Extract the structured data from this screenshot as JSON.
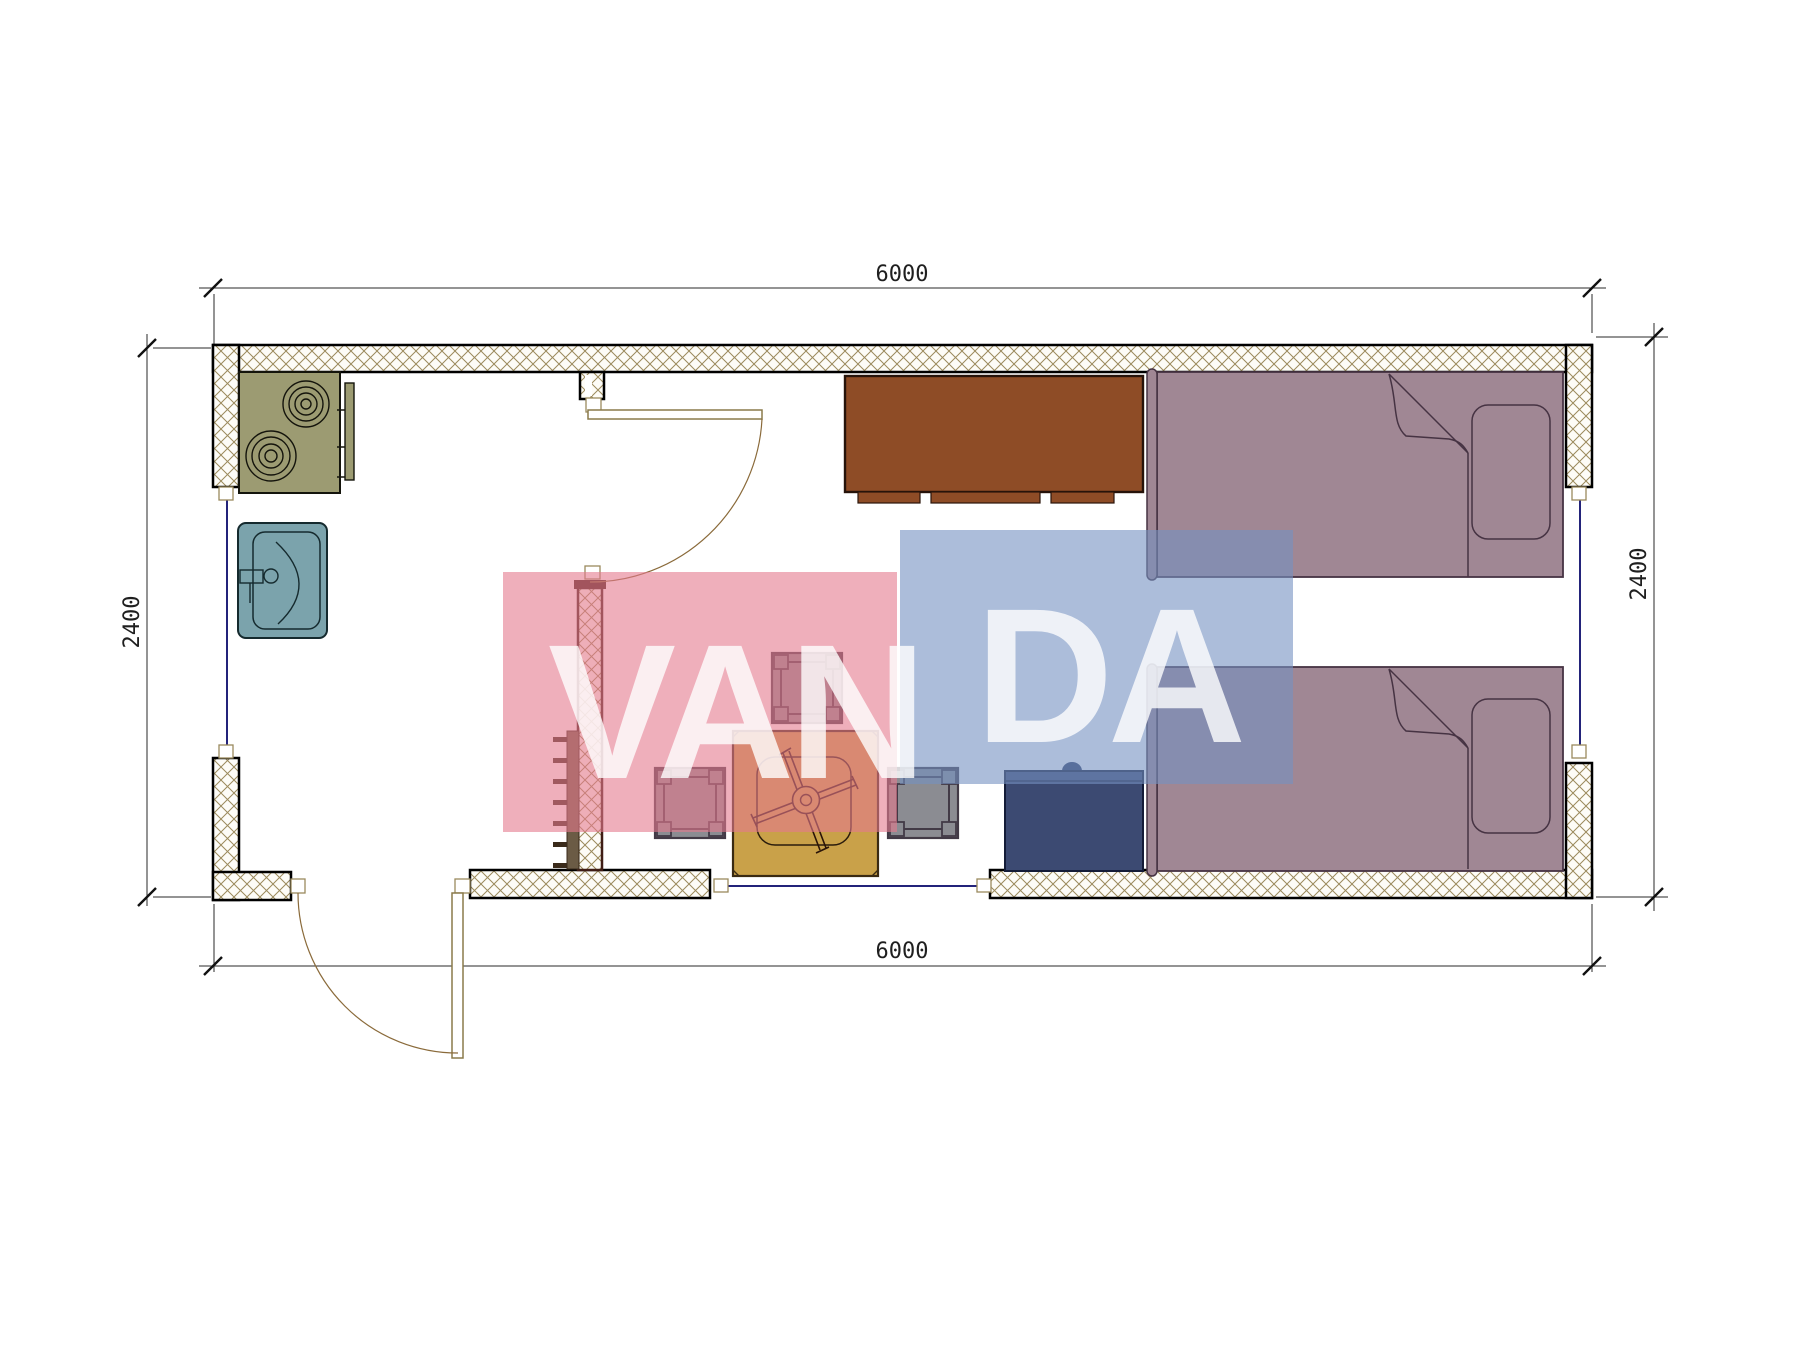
{
  "dimensions": {
    "top": "6000",
    "bottom": "6000",
    "left": "2400",
    "right": "2400"
  },
  "watermark": {
    "text": "VANDA",
    "part1": "VAN",
    "part2": "DA",
    "pink_color": "#e4798e",
    "blue_color": "#7491c2",
    "letter_color": "#ffffff"
  },
  "plan": {
    "colors": {
      "wall_fill": "#fdfcf7",
      "wall_hatch": "#9b8a5c",
      "wall_border": "#000000",
      "interior_wall_border": "#3f1d15",
      "window": "#23237a",
      "door": "#8a7a4a",
      "stove": "#9c9b72",
      "sink": "#7ba3ac",
      "wardrobe": "#8e4c26",
      "bed": "#a08794",
      "bed_outline": "#463343",
      "nightstand": "#3c4a72",
      "table": "#c9a149",
      "stool_fill": "#8b8c92",
      "stool_frame": "#423a46",
      "radiator": "#6b5b45"
    },
    "furniture": [
      "stove",
      "kitchen-counter",
      "sink",
      "wardrobe",
      "single-bed",
      "single-bed",
      "nightstand",
      "square-table",
      "stool",
      "stool",
      "stool",
      "radiator"
    ],
    "openings": [
      "entry-door",
      "interior-door",
      "window-left",
      "window-right",
      "window-bottom"
    ]
  }
}
